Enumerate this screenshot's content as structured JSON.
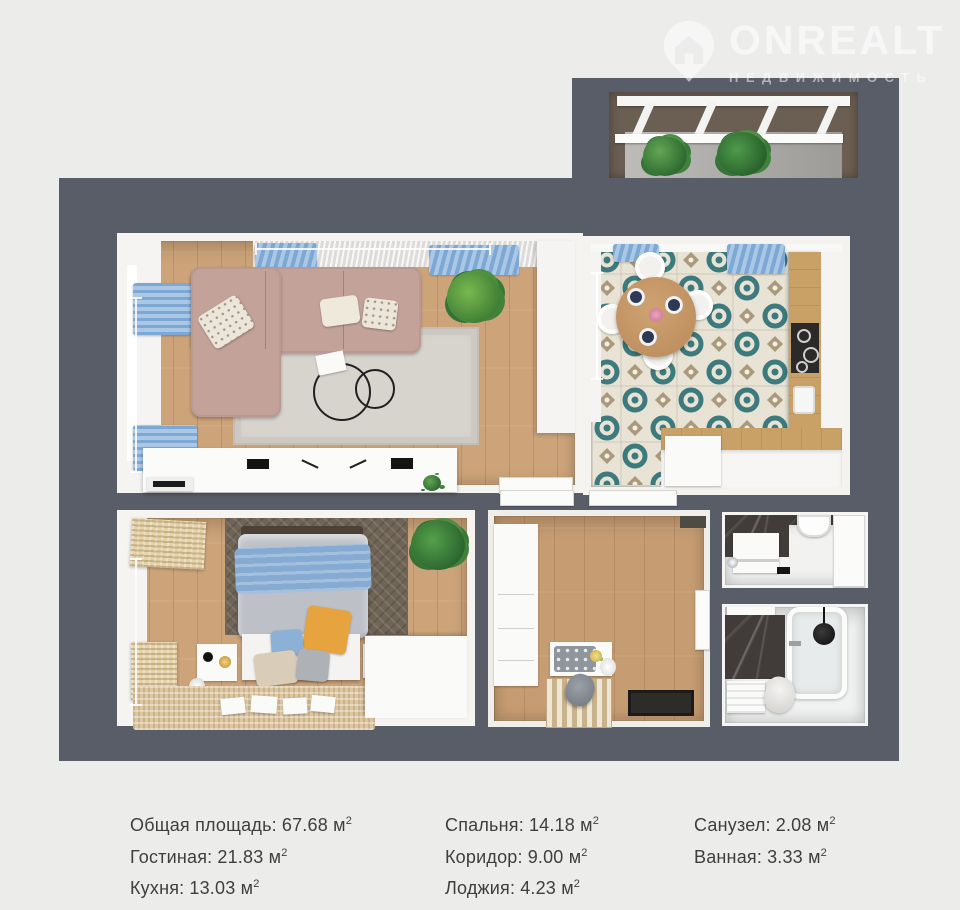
{
  "logo": {
    "title": "ONREALT",
    "subtitle": "НЕДВИЖИМОСТЬ"
  },
  "legend": {
    "col1": [
      {
        "label": "Общая площадь:",
        "value": "67.68 м",
        "sup": "2"
      },
      {
        "label": "Гостиная:",
        "value": "21.83 м",
        "sup": "2"
      },
      {
        "label": "Кухня:",
        "value": "13.03 м",
        "sup": "2"
      }
    ],
    "col2": [
      {
        "label": "Спальня:",
        "value": "14.18 м",
        "sup": "2"
      },
      {
        "label": "Коридор:",
        "value": "9.00 м",
        "sup": "2"
      },
      {
        "label": "Лоджия:",
        "value": "4.23 м",
        "sup": "2"
      }
    ],
    "col3": [
      {
        "label": "Санузел:",
        "value": "2.08 м",
        "sup": "2"
      },
      {
        "label": "Ванная:",
        "value": "3.33 м",
        "sup": "2"
      }
    ]
  },
  "colors": {
    "bg": "#ececeb",
    "wall": "#595d67",
    "curtain-blue": "#8fb3d9",
    "sofa-rose": "#c3a29a",
    "tile-teal": "#3c7a7d",
    "orange-pillow": "#e7a43e",
    "text": "#3e3e3e"
  }
}
